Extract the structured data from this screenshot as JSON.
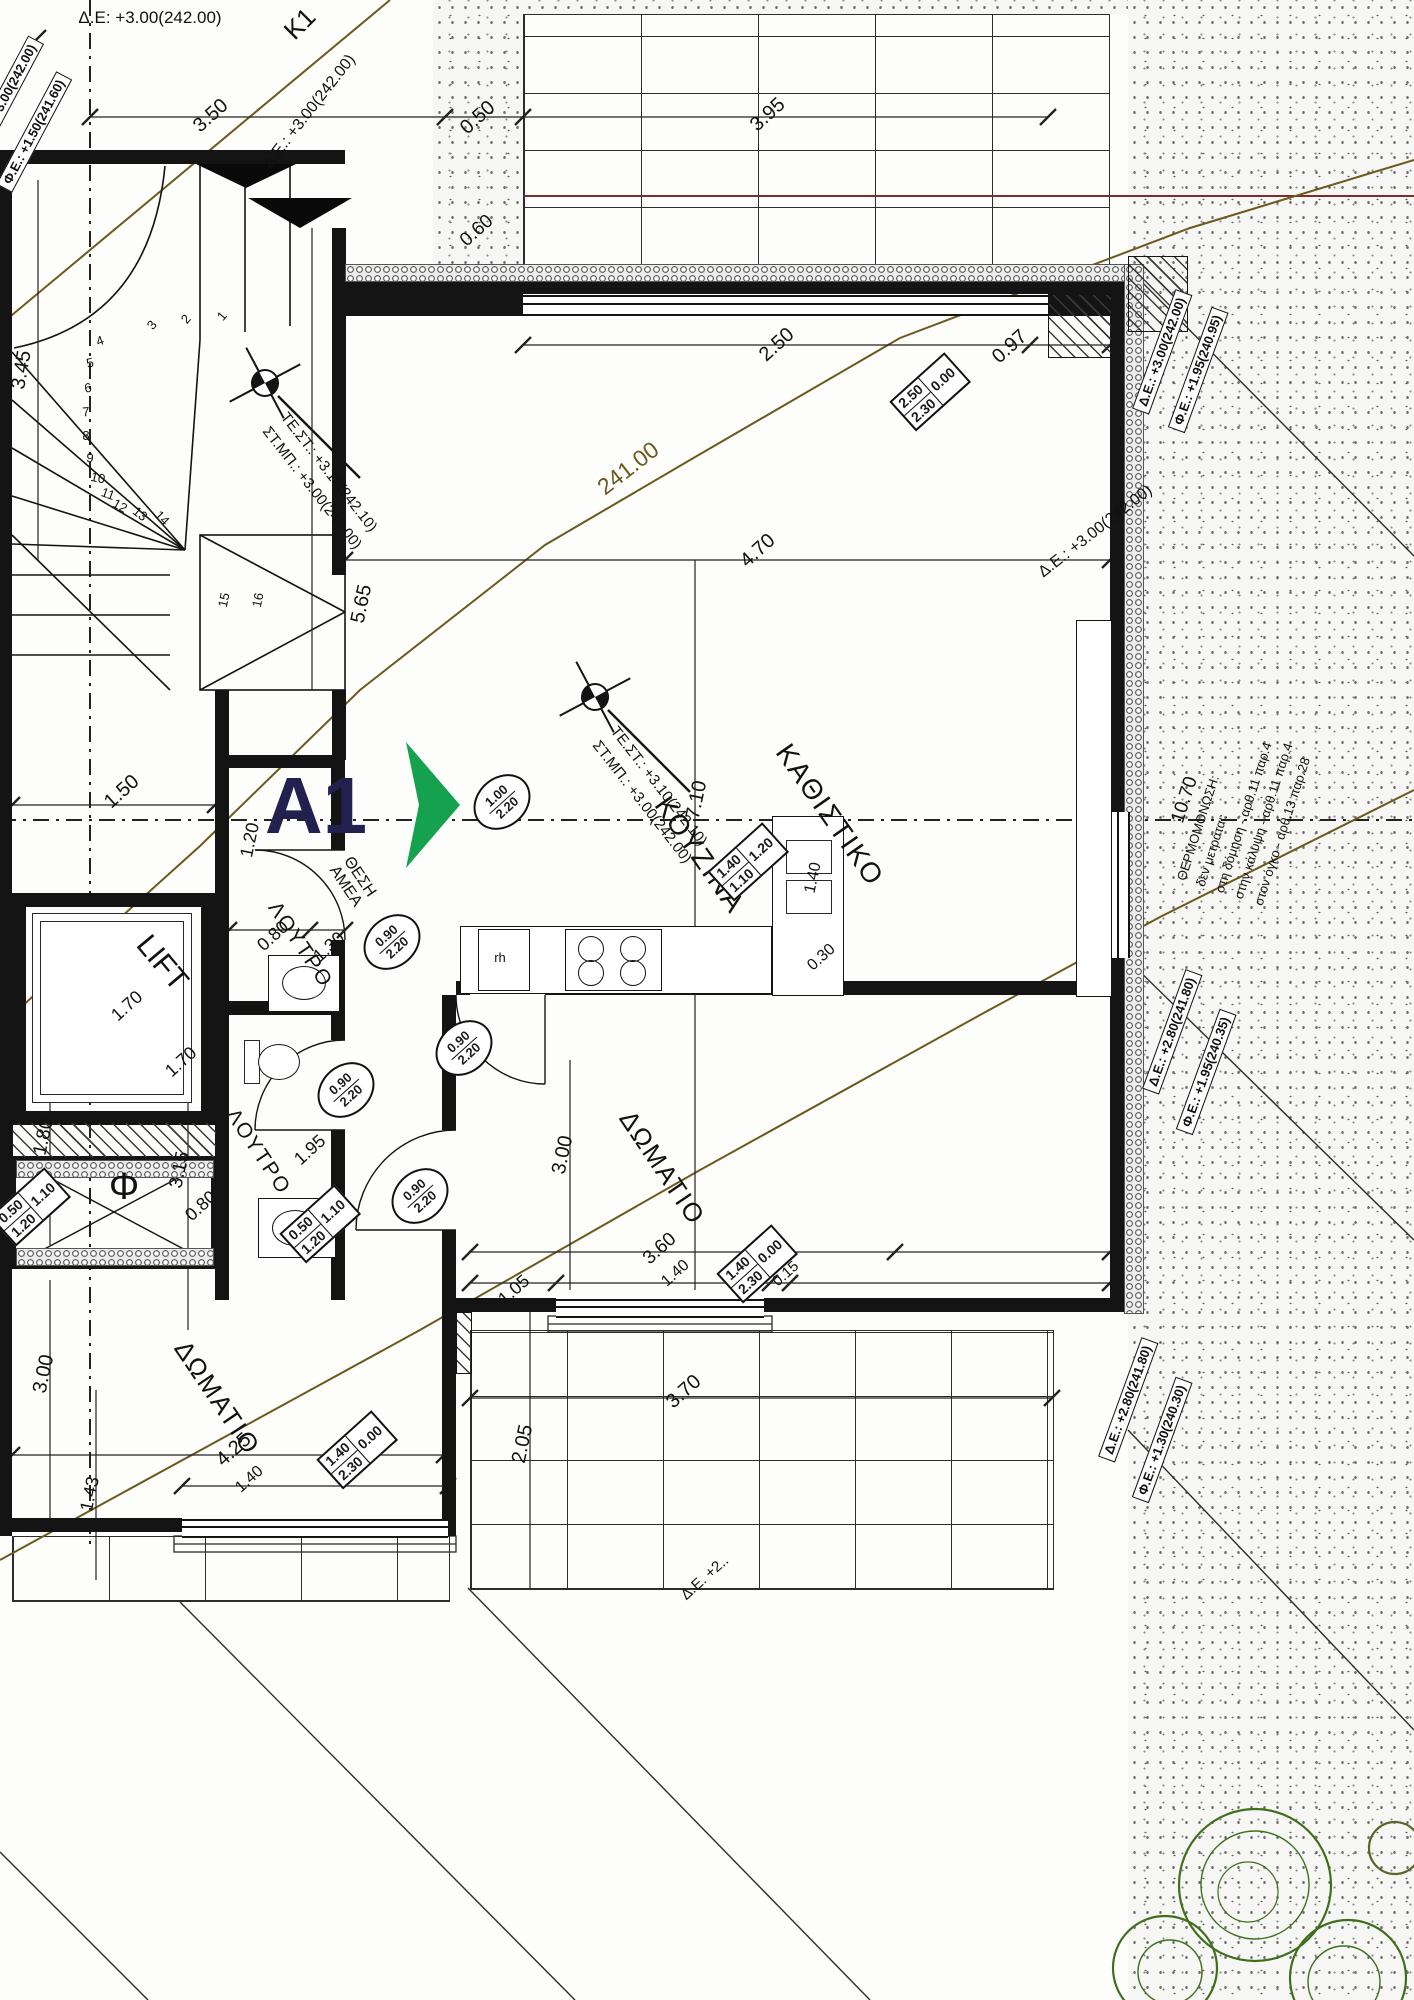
{
  "drawing": {
    "type": "architectural floor plan",
    "unit_label": "A1",
    "contour_label": "241.00"
  },
  "colors": {
    "wall": "#141414",
    "contour": "#6b5a1c",
    "accent_green": "#16a14e",
    "navy": "#22204f",
    "red_line": "#7e2b2b",
    "plant_green": "#3f6f1d"
  },
  "rooms": {
    "living": "ΚΑΘΙΣΤΙΚΟ",
    "kitchen": "ΚΟΥΖΙΝΑ",
    "bath1": "ΛΟΥΤΡΟ",
    "bath2": "ΛΟΥΤΡΟ",
    "bed1": "ΔΩΜΑΤΙΟ",
    "bed2": "ΔΩΜΑΤΙΟ",
    "lift": "LIFT",
    "amea": "ΘΕΣΗ\nΑΜΕΑ",
    "shaft": "Φ",
    "appliance": "rh"
  },
  "labels": {
    "ax_top": "Δ.Ε: +3.00(242.00)",
    "k1": "K1",
    "de_diag_top": "Δ.Ε.: +3.00(242.00)",
    "de_diag_right": "Δ.Ε.: +3.00(242.00)",
    "de_partial": "Δ.Ε. +2..",
    "d_350": "3.50",
    "d_050": "0.50",
    "d_395": "3.95",
    "d_060": "0.60",
    "d_250": "2.50",
    "d_097": "0.97",
    "d_470": "4.70",
    "d_710": "7.10",
    "d_345": "3.45",
    "d_565": "5.65",
    "d_150": "1.50",
    "d_080a": "0.80",
    "d_130": "1.30",
    "d_120": "1.20",
    "d_170a": "1.70",
    "d_170b": "1.70",
    "d_080b": "0.80",
    "d_195": "1.95",
    "d_315": "3.15",
    "d_180": "1.80",
    "d_300r": "3.00",
    "d_360": "3.60",
    "d_140a": "1.40",
    "d_105": "1.05",
    "d_015": "0.15",
    "d_370": "3.70",
    "d_205": "2.05",
    "d_300l": "3.00",
    "d_425": "4.25",
    "d_140b": "1.40",
    "d_143": "1.43",
    "d_140k": "1.40",
    "d_030": "0.30",
    "d_1070": "10.70"
  },
  "edge_boxes": {
    "eb1": "Δ.Ε.: +3.00(242.00)",
    "eb2": "Φ.Ε.: +1.50(241.60)"
  },
  "level_boxes": {
    "lt1": "Δ.Ε.: +3.00(242.00)",
    "lt2": "Φ.Ε.: +1.95(240.95)",
    "lt3": "Δ.Ε.: +2.80(241.80)",
    "lt4": "Φ.Ε.: +1.95(240.35)",
    "lt5": "Δ.Ε.: +2.80(241.80)",
    "lt6": "Φ.Ε.: +1.30(240.30)"
  },
  "level_markers": {
    "m1": {
      "line1": "ΤΕ.ΣΤ.: +3.10(242.10)",
      "line2": "ΣΤ.ΜΠ.: +3.00(242.00)"
    },
    "m2": {
      "line1": "ΤΕ.ΣΤ.: +3.10(242.10)",
      "line2": "ΣΤ.ΜΠ.: +3.00(242.00)"
    }
  },
  "window_tags": {
    "wt1": {
      "w": "2.50",
      "h": "2.30",
      "side": "0.00"
    },
    "wt2": {
      "w": "1.40",
      "h": "1.10",
      "side": "1.20"
    },
    "wt3": {
      "w": "0.50",
      "h": "1.20",
      "side": "1.10"
    },
    "wt4": {
      "w": "0.50",
      "h": "1.20",
      "side": "1.10"
    },
    "wt5": {
      "w": "1.40",
      "h": "2.30",
      "side": "0.00"
    },
    "wt6": {
      "w": "1.40",
      "h": "2.30",
      "side": "0.00"
    }
  },
  "door_tags": {
    "dt1": {
      "w": "1.00",
      "h": "2.20"
    },
    "dt2": {
      "w": "0.90",
      "h": "2.20"
    },
    "dt3": {
      "w": "0.90",
      "h": "2.20"
    },
    "dt4": {
      "w": "0.90",
      "h": "2.20"
    },
    "dt5": {
      "w": "0.90",
      "h": "2.20"
    }
  },
  "stair_numbers": [
    "1",
    "2",
    "3",
    "4",
    "5",
    "6",
    "7",
    "8",
    "9",
    "10",
    "11",
    "12",
    "13",
    "14",
    "15",
    "16"
  ],
  "notes": {
    "n1": "ΘΕΡΜΟΜΟΝΩΣΗ:",
    "n2": "δεν μετράται:",
    "n3": "στη δόμηση - αρθ.11 παρ.4",
    "n4": "στην κάλυψη - αρθ.11 παρ.4",
    "n5": "στον όγκο - αρθ.13 παρ.28"
  }
}
